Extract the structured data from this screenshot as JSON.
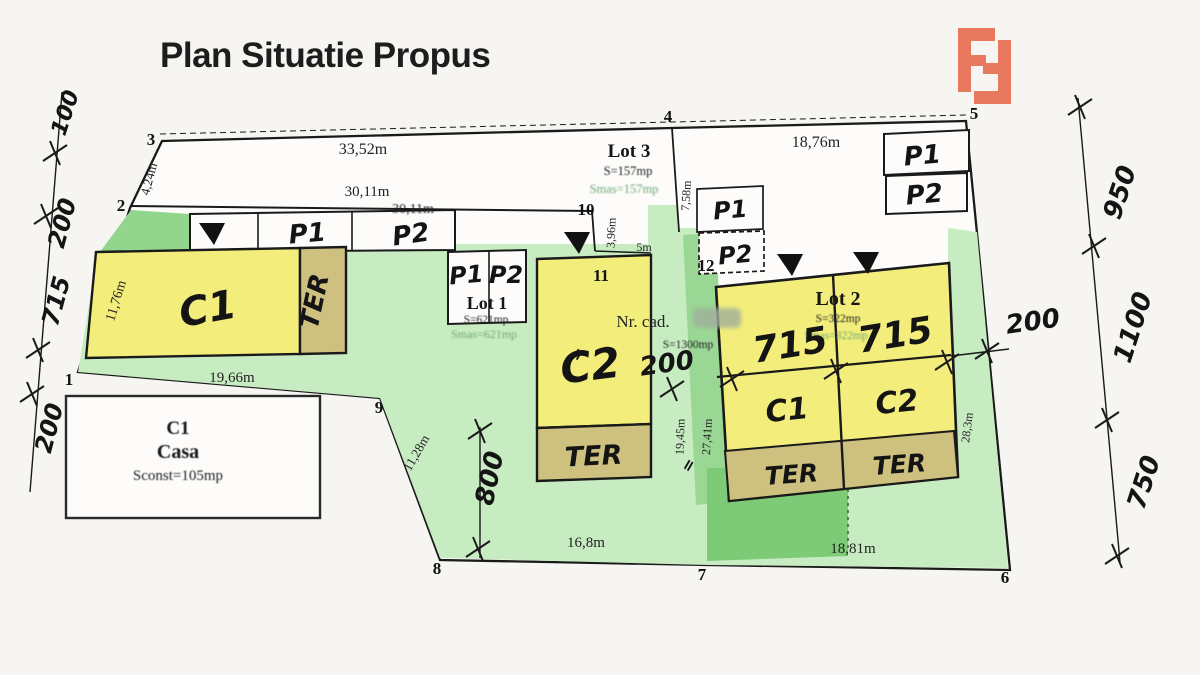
{
  "page": {
    "title": "Plan Situatie Propus",
    "accent_color": "#e8795f",
    "paper_color": "#f7f5f2"
  },
  "points": {
    "p1": "1",
    "p2": "2",
    "p3": "3",
    "p4": "4",
    "p5": "5",
    "p6": "6",
    "p7": "7",
    "p8": "8",
    "p9": "9",
    "p10": "10",
    "p11": "11",
    "p12": "12"
  },
  "dims": {
    "top_33": "33,52m",
    "top_30": "30,11m",
    "top_30b": "30,11m",
    "top_18": "18,76m",
    "e_424": "4,24m",
    "e_1176": "11,76m",
    "c1_width": "19,66m",
    "d_396": "3,96m",
    "d_5": "5m",
    "d_758": "7,58m",
    "d_1128": "11,28m",
    "d_168": "16,8m",
    "d_1881": "18,81m",
    "d_1945": "19,45m",
    "d_2741": "27,41m",
    "d_283": "28,3m"
  },
  "hand": {
    "left_100": "100",
    "left_200a": "200",
    "left_715": "715",
    "left_200b": "200",
    "right_950": "950",
    "right_1100": "1100",
    "right_750": "750",
    "mid_200": "200",
    "right_200": "200",
    "v_800": "800",
    "lot2_715L": "715",
    "lot2_715R": "715",
    "c1": "C1",
    "c2": "C2",
    "ter": "TER",
    "lot2_c1": "C1",
    "lot2_c2": "C2",
    "p1": "P1",
    "p2": "P2",
    "eq": "="
  },
  "lot1": {
    "name": "Lot 1",
    "s": "S=621mp",
    "smas": "Smas=621mp"
  },
  "lot2": {
    "name": "Lot 2",
    "s": "S=322mp",
    "smas": "Smas=322mp"
  },
  "lot3": {
    "name": "Lot 3",
    "s": "S=157mp",
    "smas": "Smas=157mp"
  },
  "parcel": {
    "nr_cad": "Nr. cad.",
    "s": "S=1300mp"
  },
  "casa": {
    "c1": "C1",
    "name": "Casa",
    "s": "Sconst=105mp"
  }
}
